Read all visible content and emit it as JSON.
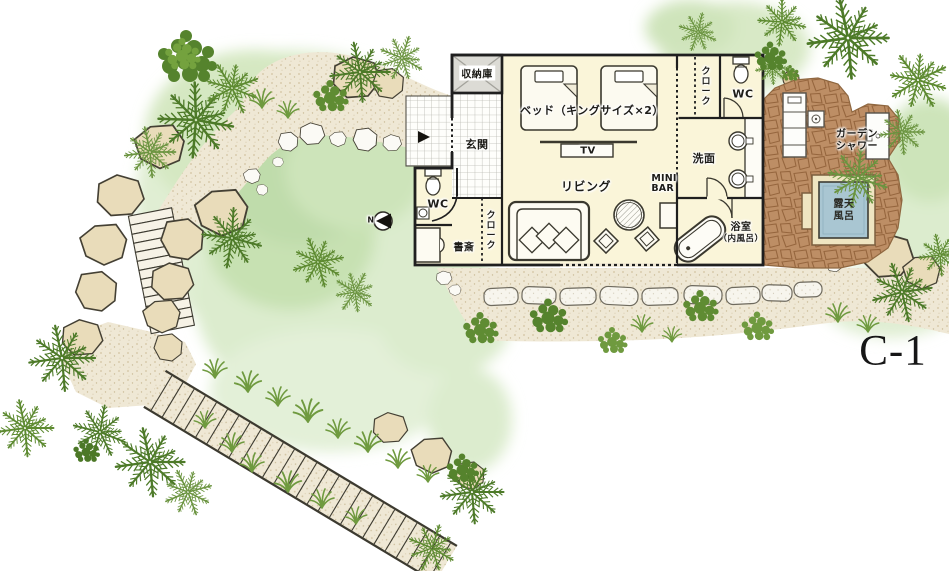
{
  "unit": {
    "label": "C-1"
  },
  "compass": {
    "north": "N"
  },
  "rooms": {
    "storage": "収納庫",
    "entrance": "玄関",
    "bed": "ベッド（キングサイズ×2）",
    "tv": "TV",
    "living": "リビング",
    "minibar_l1": "MINI",
    "minibar_l2": "BAR",
    "wc_left": "WC",
    "cloak_left": "クローク",
    "study": "書斎",
    "cloak_right": "クローク",
    "wc_right": "WC",
    "washroom": "洗面",
    "bath_l1": "浴室",
    "bath_l2": "（内風呂）",
    "garden_shower_l1": "ガーデン",
    "garden_shower_l2": "シャワー",
    "open_air_bath_l1": "露天",
    "open_air_bath_l2": "風呂"
  },
  "colors": {
    "floor": "#faf5d9",
    "wall": "#1f1f1f",
    "terrace": "#bd8e65",
    "bath_water": "#a9c6d2",
    "path": "#efe8d5",
    "green_wash": "#dcecce",
    "palm": "#4d7a28"
  }
}
